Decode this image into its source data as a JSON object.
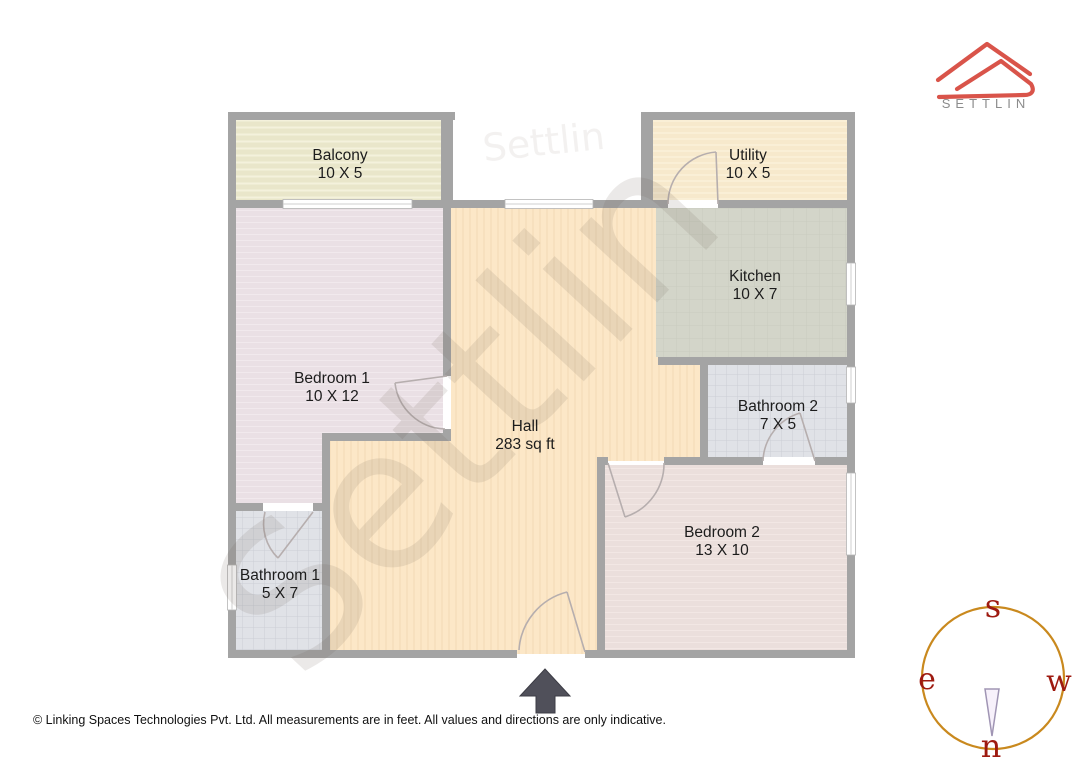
{
  "brand": {
    "name": "SETTLIN"
  },
  "watermark": {
    "text": "Settlin"
  },
  "rooms": [
    {
      "id": "balcony",
      "name": "Balcony",
      "dims": "10 X 5"
    },
    {
      "id": "utility",
      "name": "Utility",
      "dims": "10 X 5"
    },
    {
      "id": "kitchen",
      "name": "Kitchen",
      "dims": "10 X 7"
    },
    {
      "id": "bathroom2",
      "name": "Bathroom 2",
      "dims": "7 X 5"
    },
    {
      "id": "bedroom1",
      "name": "Bedroom 1",
      "dims": "10 X 12"
    },
    {
      "id": "hall",
      "name": "Hall",
      "dims": "283 sq ft"
    },
    {
      "id": "bedroom2",
      "name": "Bedroom 2",
      "dims": "13 X 10"
    },
    {
      "id": "bathroom1",
      "name": "Bathroom 1",
      "dims": "5 X 7"
    }
  ],
  "compass": {
    "top": "s",
    "left": "e",
    "right": "w",
    "bottom": "n"
  },
  "footer": {
    "copyright": "© Linking Spaces Technologies Pvt. Ltd. All measurements are in feet. All values and directions are only indicative."
  },
  "colors": {
    "wall": "#a4a4a4",
    "hall": "#fce7c7",
    "bedroom1": "#eae0e5",
    "bedroom2": "#ebdfdc",
    "bathroom": "#e0e2e7",
    "kitchen": "#d3d5c9",
    "balcony": "#e9e6ca",
    "utility": "#f7e9cc",
    "logo_red": "#d9544a",
    "compass_ring": "#c9891e",
    "compass_letters": "#9e1a10",
    "north_arrow": "#50505a"
  }
}
